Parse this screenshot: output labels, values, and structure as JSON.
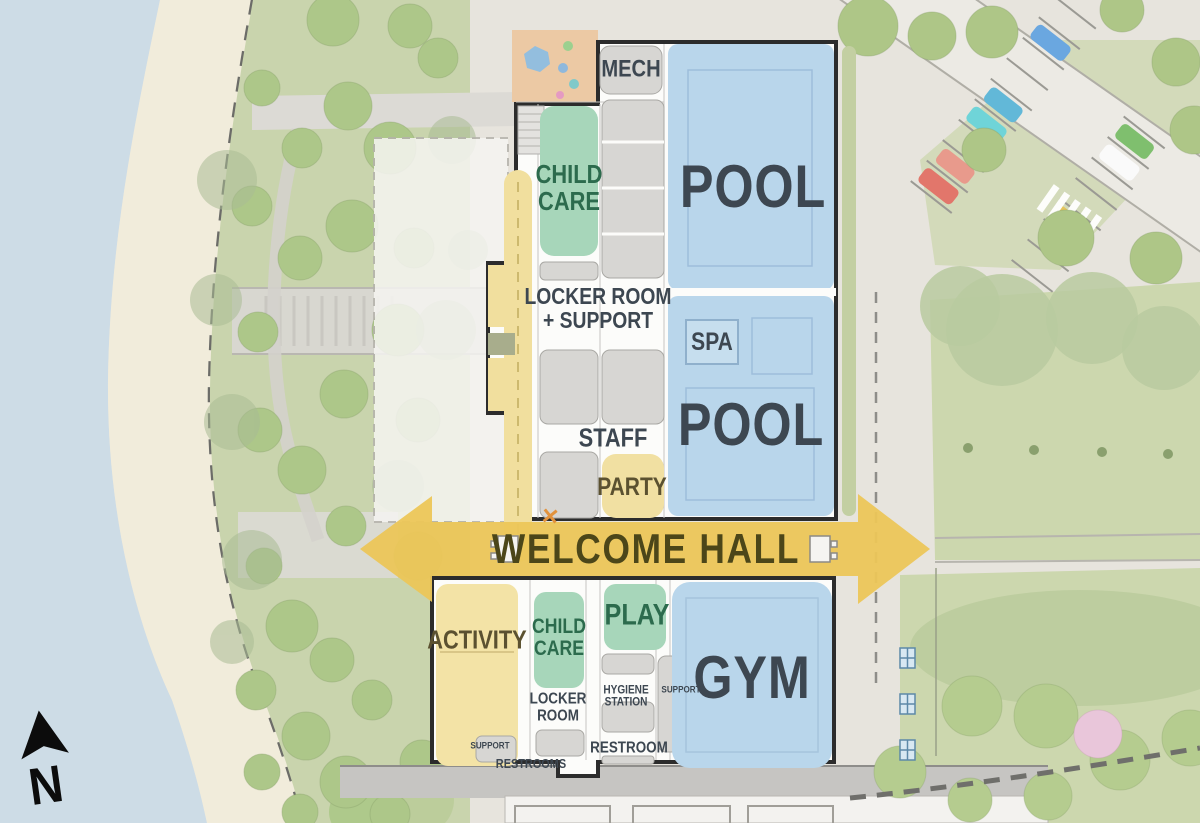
{
  "legend": {
    "north": "N"
  },
  "rooms": {
    "mech": "MECH",
    "child_care_north": "CHILD\nCARE",
    "pool_upper": "POOL",
    "locker_support": "LOCKER ROOM\n+ SUPPORT",
    "spa": "SPA",
    "pool_lower": "POOL",
    "staff": "STAFF",
    "party": "PARTY",
    "welcome_hall": "WELCOME HALL",
    "activity": "ACTIVITY",
    "child_care_south": "CHILD\nCARE",
    "play": "PLAY",
    "gym": "GYM",
    "locker_room": "LOCKER\nROOM",
    "hygiene_station": "HYGIENE\nSTATION",
    "support_gym": "SUPPORT",
    "restroom": "RESTROOM",
    "support_activity": "SUPPORT",
    "restrooms": "RESTROOMS",
    "x_marker": "✕"
  },
  "colors": {
    "pool_blue": "#b9d6eb",
    "room_green": "#a7d6ba",
    "room_yellow": "#f3e3a6",
    "arrow_yellow": "#ecc658",
    "wall_dark": "#2c2c2c",
    "water": "#cddce6",
    "beach": "#f1ecdb",
    "lawn_green": "#ccd7ae",
    "label_dark": "#3d4751",
    "label_green": "#2c6b4d",
    "label_olive": "#4c4619",
    "marker_orange": "#e2923c"
  }
}
